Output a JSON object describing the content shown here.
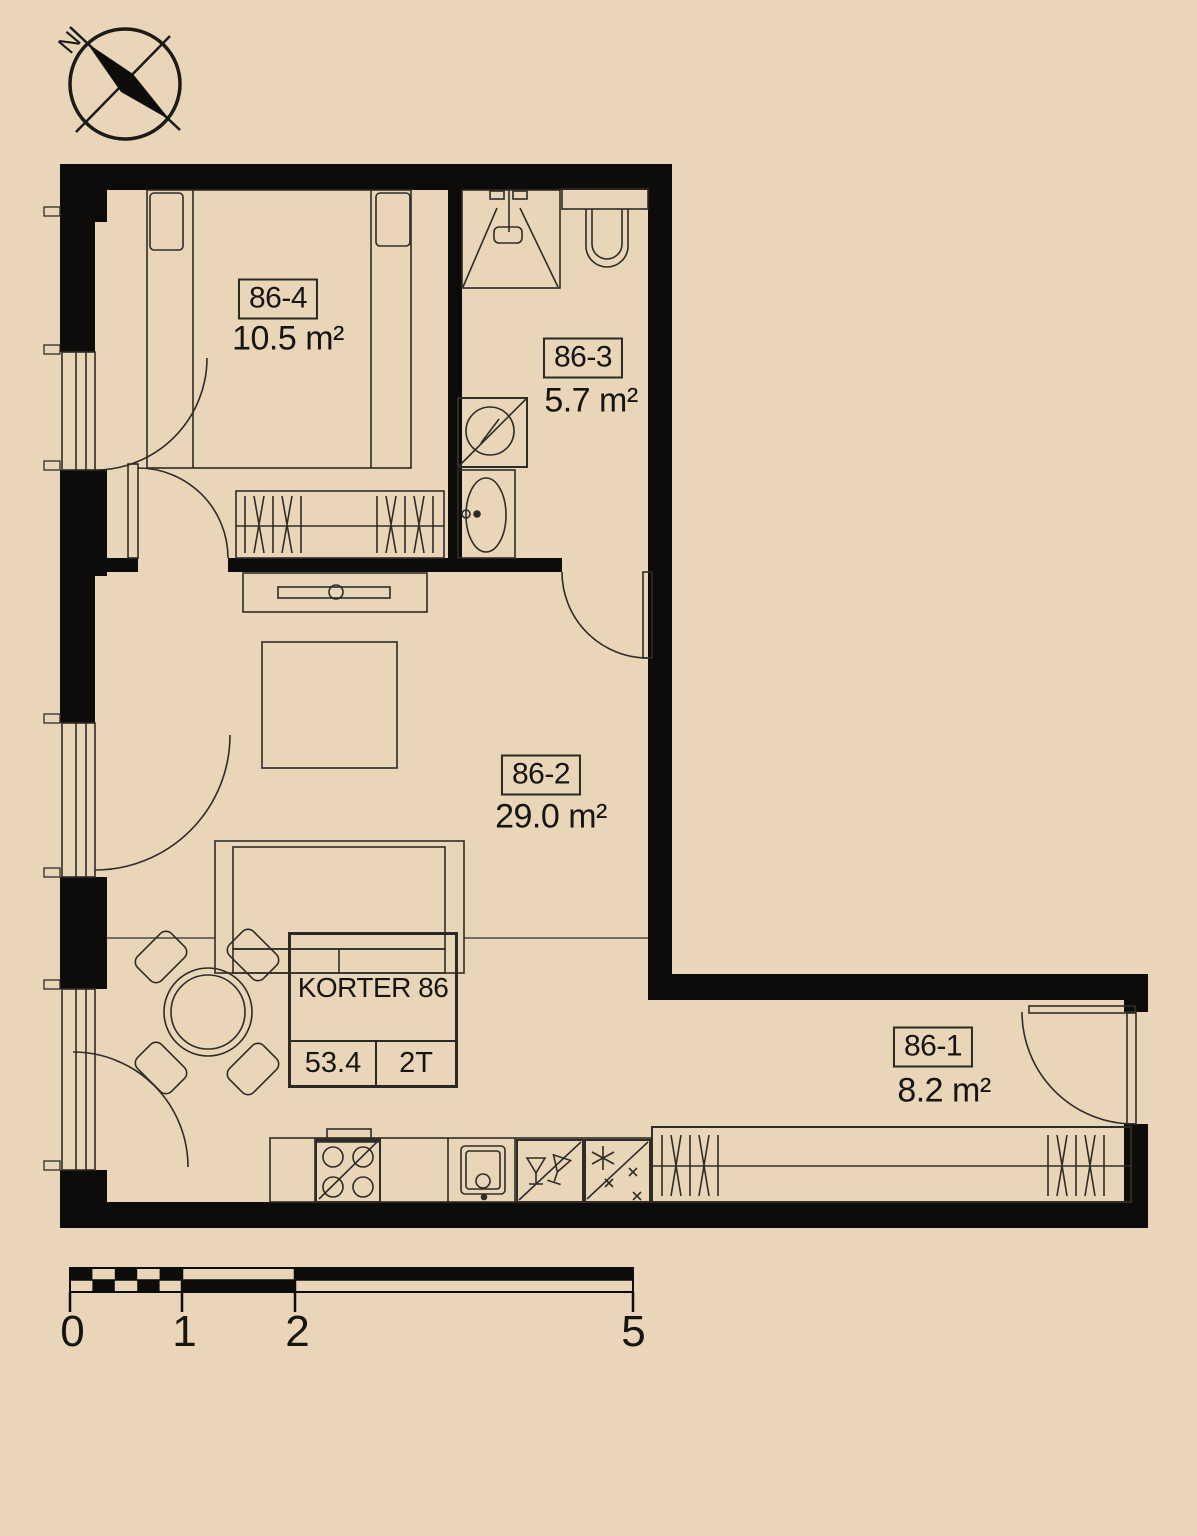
{
  "floor_plan": {
    "compass_north": "N",
    "rooms": [
      {
        "label": "86-1",
        "area": "8.2 m²"
      },
      {
        "label": "86-2",
        "area": "29.0 m²"
      },
      {
        "label": "86-3",
        "area": "5.7 m²"
      },
      {
        "label": "86-4",
        "area": "10.5 m²"
      }
    ],
    "info": {
      "title": "KORTER 86",
      "total_area": "53.4",
      "unit_type": "2T"
    },
    "scale": {
      "labels": [
        "0",
        "1",
        "2",
        "5"
      ]
    },
    "colors": {
      "background": "#e9d6b8",
      "wall": "#0d0c0a",
      "line": "#2e2c27"
    }
  }
}
